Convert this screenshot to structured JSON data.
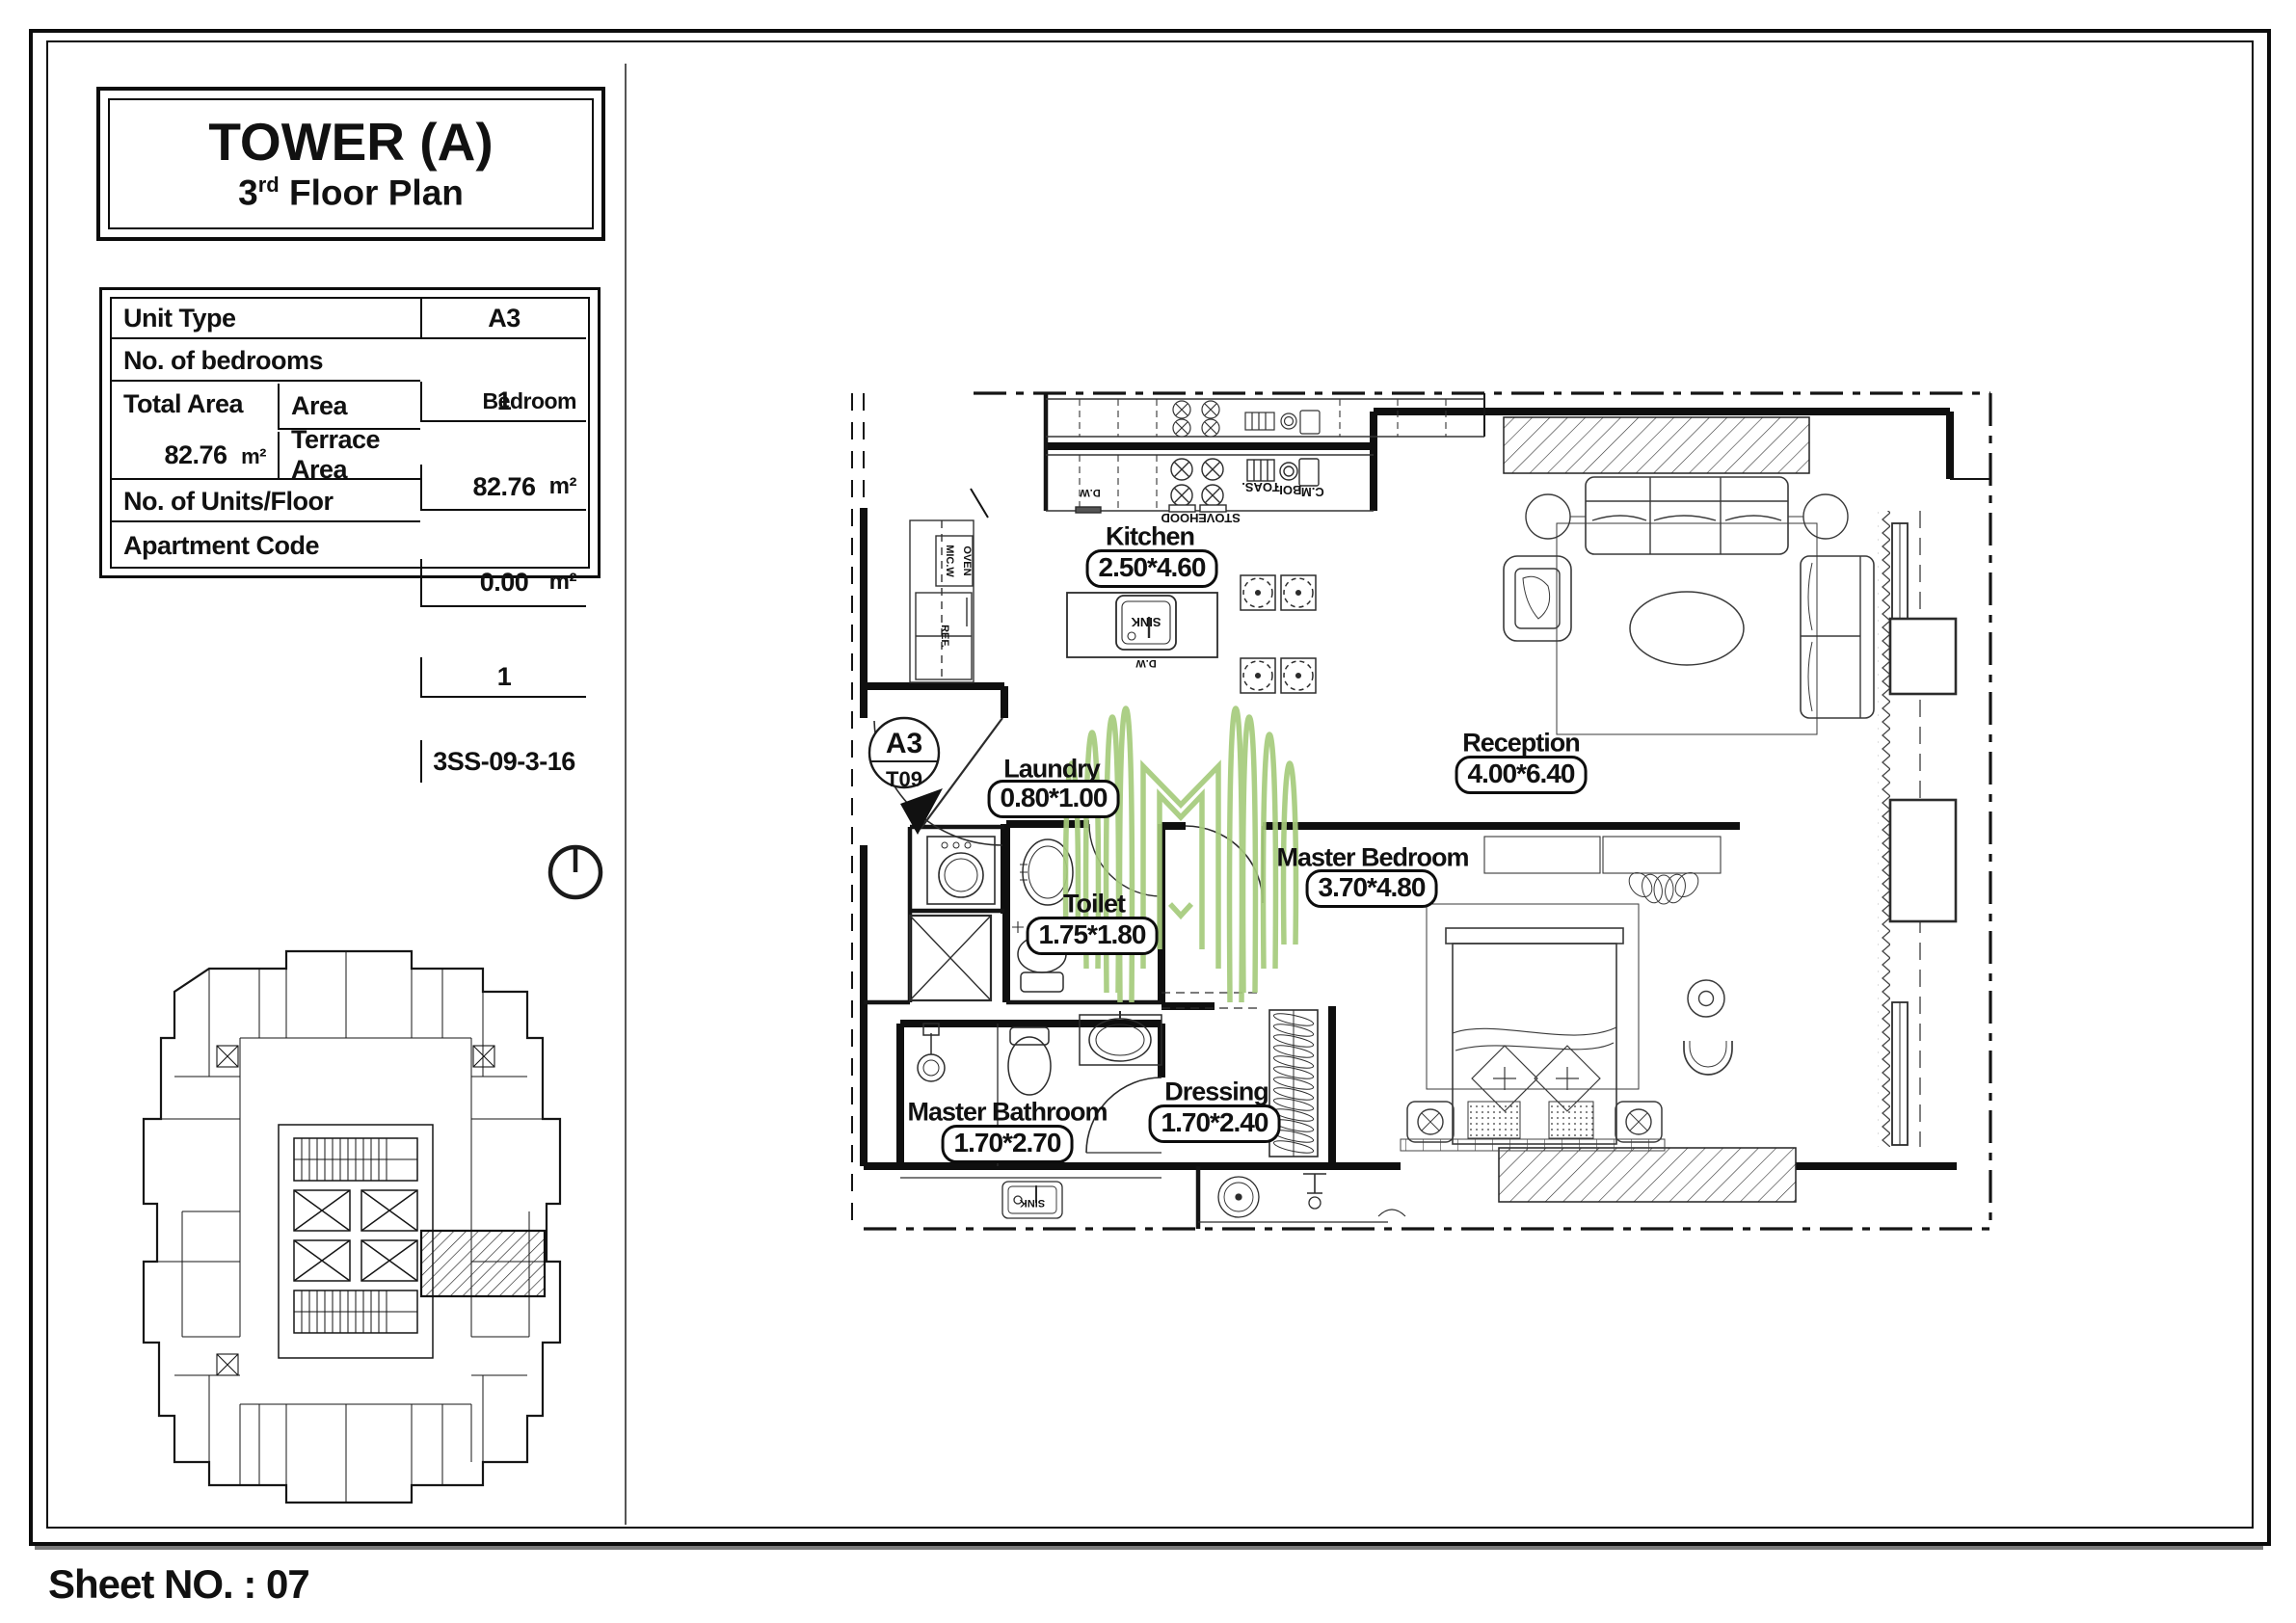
{
  "title_block": {
    "line1": "TOWER (A)",
    "floor_num": "3",
    "floor_ord": "rd",
    "line2_rest": " Floor Plan"
  },
  "info_table": {
    "unit_type_label": "Unit Type",
    "unit_type_value": "A3",
    "bedrooms_label": "No. of bedrooms",
    "bedrooms_value": "1",
    "bedrooms_unit": "Bedroom",
    "total_area_label": "Total Area",
    "total_area_value": "82.76",
    "total_area_unit": "m²",
    "area_label": "Area",
    "area_value": "82.76",
    "area_unit": "m²",
    "terrace_label": "Terrace Area",
    "terrace_value": "0.00",
    "terrace_unit": "m²",
    "units_per_floor_label": "No. of Units/Floor",
    "units_per_floor_value": "1",
    "apartment_code_label": "Apartment Code",
    "apartment_code_value": "3SS-09-3-16"
  },
  "unit_marker": {
    "code": "A3",
    "tower": "T09"
  },
  "rooms": [
    {
      "name": "Kitchen",
      "dims": "2.50*4.60"
    },
    {
      "name": "Laundry",
      "dims": "0.80*1.00"
    },
    {
      "name": "Toilet",
      "dims": "1.75*1.80"
    },
    {
      "name": "Reception",
      "dims": "4.00*6.40"
    },
    {
      "name": "Master Bedroom",
      "dims": "3.70*4.80"
    },
    {
      "name": "Dressing",
      "dims": "1.70*2.40"
    },
    {
      "name": "Master Bathroom",
      "dims": "1.70*2.70"
    }
  ],
  "fixture_labels": {
    "hood": "HOOD",
    "stove": "STOVE",
    "sink": "SINK",
    "sink_lower": "SINK",
    "toaster": "TOAS.",
    "boiler": "BOI.",
    "coffee_machine": "C.M.",
    "dishwasher": "D.W",
    "dishwasher_counter": "D.W",
    "microwave": "MIC.W",
    "oven": "OVEN",
    "refrigerator": "REF."
  },
  "sheet": {
    "number_label": "Sheet NO. : 07"
  },
  "colors": {
    "line": "#111111",
    "logo_green": "#a6cb7c"
  }
}
